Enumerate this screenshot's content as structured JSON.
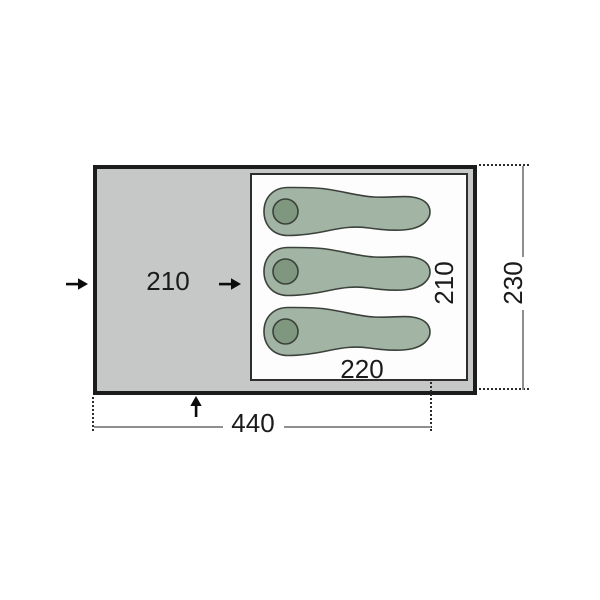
{
  "diagram": {
    "kind": "tent-floorplan",
    "dimensions": {
      "porch_width": "210",
      "inner_width": "220",
      "inner_depth": "210",
      "overall_width": "440",
      "overall_depth": "230"
    },
    "sleeping_bags": {
      "count": 3
    },
    "entrance_arrows": {
      "count": 3,
      "directions": [
        "right",
        "right",
        "up"
      ]
    },
    "colors": {
      "floor": "#c6c8c7",
      "tent_outline": "#1c1c1a",
      "inner_cabin_border": "#2e2e2e",
      "inner_cabin_fill": "#fdfdfd",
      "sleeping_bag": "#a2b4a3",
      "pillow": "#7f967f",
      "dimension_line": "#8f8f8f",
      "extension_line": "#2b2b2b",
      "arrow": "#0c0c0c",
      "label_text": "#1b1b1b"
    }
  }
}
